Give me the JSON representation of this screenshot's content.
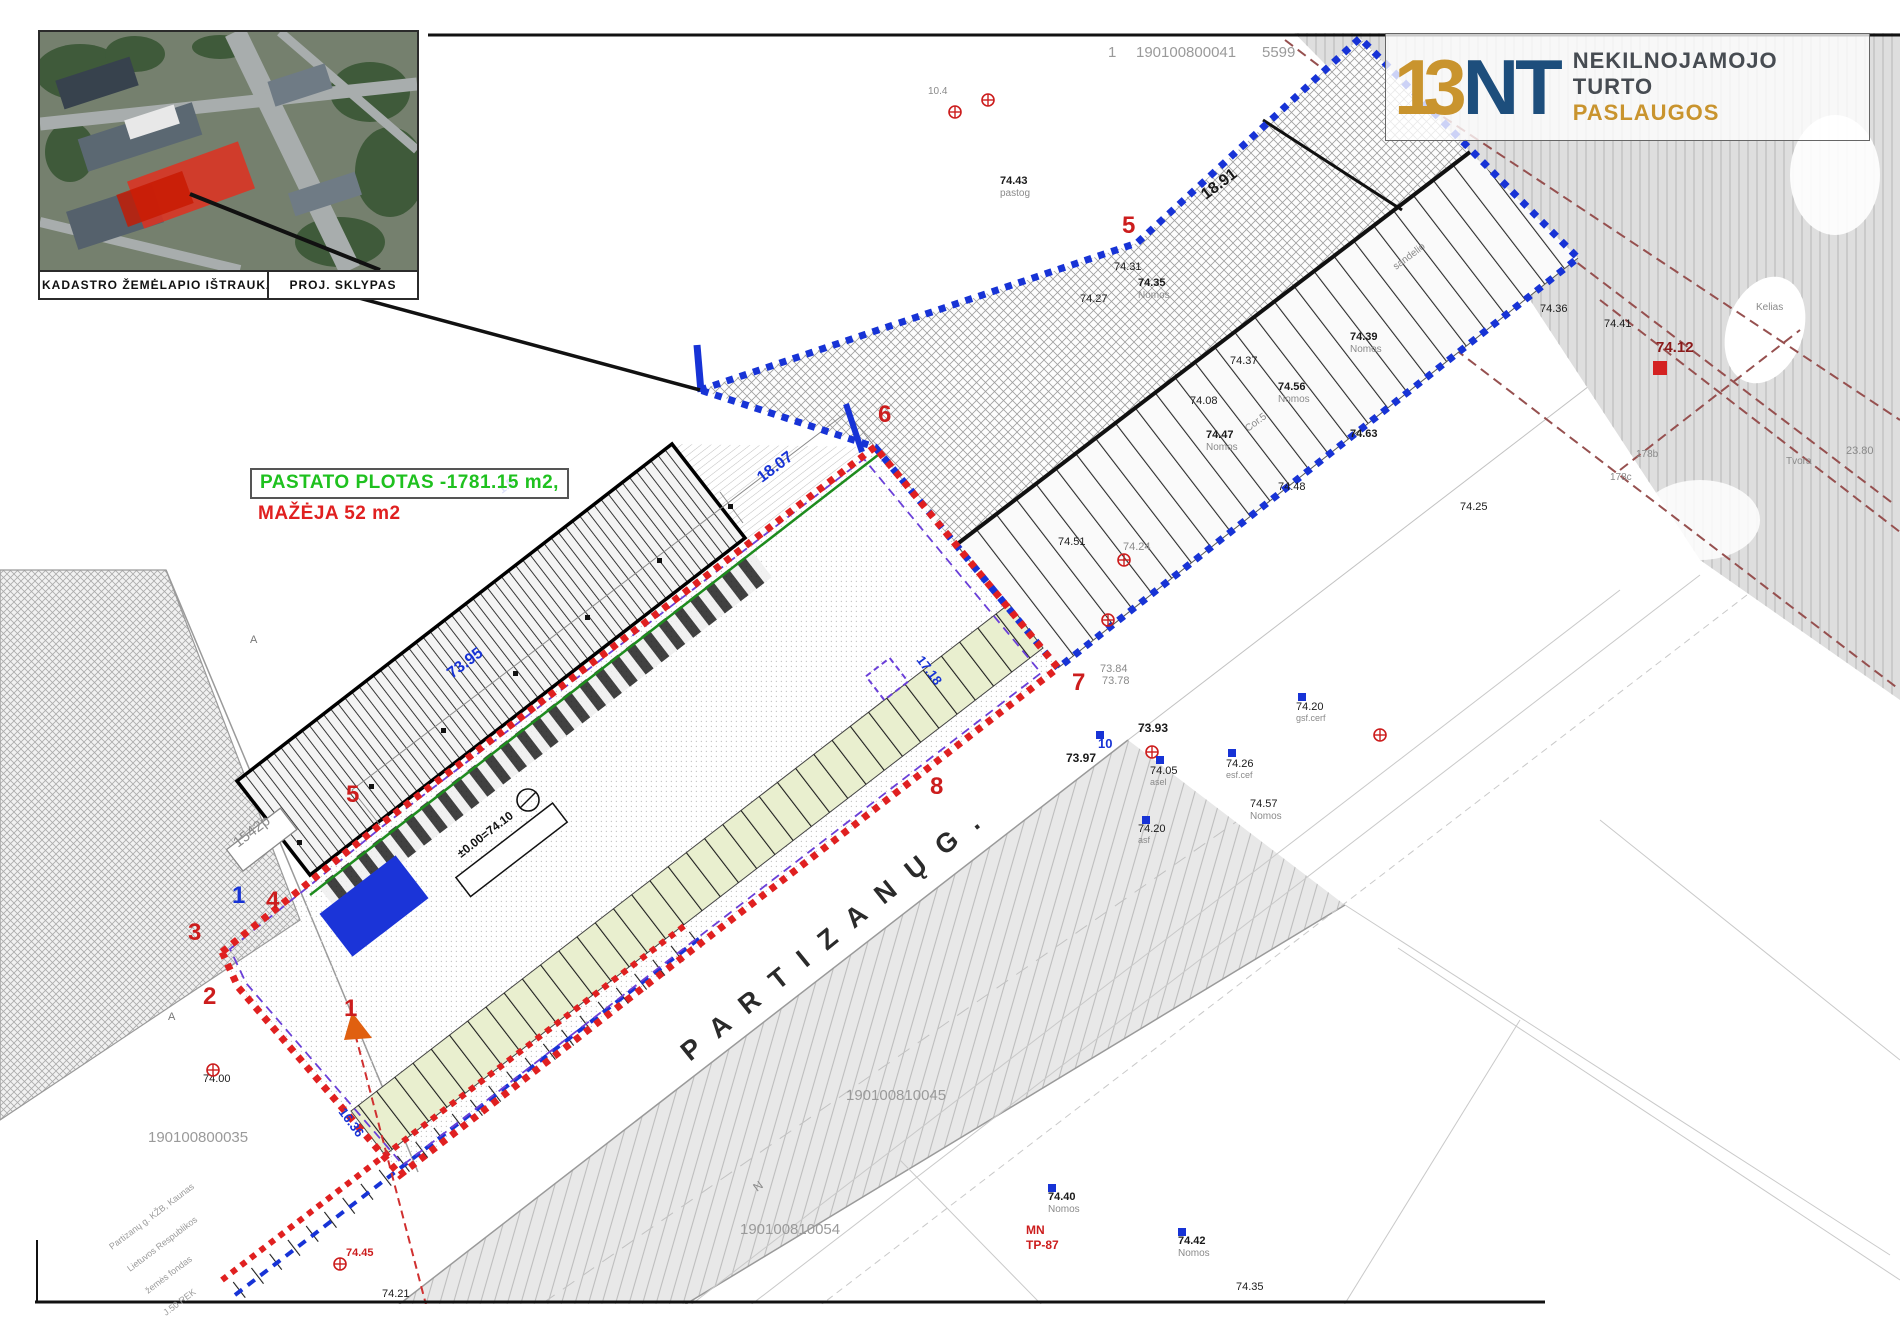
{
  "colors": {
    "red_boundary": "#e02020",
    "blue_boundary": "#1733d6",
    "violet_dash": "#6a3fd8",
    "green_line": "#1e8c1e",
    "logo_navy": "#1d4e7c",
    "logo_gold": "#c9942e",
    "note_green": "#1fc11f",
    "note_red": "#e02020",
    "gray_text": "#9a9a9a"
  },
  "inset": {
    "caption_left": "KADASTRO ŽEMĖLAPIO IŠTRAUKA",
    "caption_right": "PROJ. SKLYPAS"
  },
  "area_note": {
    "line1": "PASTATO PLOTAS -1781.15 m2,",
    "line2": "MAŽĖJA 52 m2"
  },
  "logo": {
    "mark_13": "13",
    "mark_nt": "NT",
    "word1": "NEKILNOJAMOJO",
    "word2": "TURTO",
    "word3": "PASLAUGOS"
  },
  "street": {
    "name": "P A R T I Z A N Ų   G ."
  },
  "plot_tag": "1542p",
  "level_box": "±0.00=74.10",
  "vertices": [
    {
      "t": "1",
      "x": 232,
      "y": 903,
      "c": "#1733d6"
    },
    {
      "t": "2",
      "x": 203,
      "y": 1004,
      "c": "#cc1d1d"
    },
    {
      "t": "3",
      "x": 188,
      "y": 940,
      "c": "#cc1d1d"
    },
    {
      "t": "4",
      "x": 266,
      "y": 908,
      "c": "#cc1d1d"
    },
    {
      "t": "5",
      "x": 346,
      "y": 802,
      "c": "#cc1d1d"
    },
    {
      "t": "6",
      "x": 878,
      "y": 422,
      "c": "#cc1d1d"
    },
    {
      "t": "7",
      "x": 1072,
      "y": 690,
      "c": "#cc1d1d"
    },
    {
      "t": "8",
      "x": 930,
      "y": 794,
      "c": "#cc1d1d"
    },
    {
      "t": "5",
      "x": 1122,
      "y": 233,
      "c": "#cc1d1d"
    },
    {
      "t": "1",
      "x": 344,
      "y": 1016,
      "c": "#cc1d1d"
    }
  ],
  "dimensions": [
    {
      "t": "18.07",
      "x": 762,
      "y": 483,
      "s": 16,
      "rot": -37
    },
    {
      "t": "73.95",
      "x": 452,
      "y": 679,
      "s": 16,
      "rot": -37
    },
    {
      "t": "1.5",
      "x": 502,
      "y": 494,
      "s": 12,
      "rot": -37
    },
    {
      "t": "17.18",
      "x": 916,
      "y": 660,
      "s": 13,
      "rot": 53
    },
    {
      "t": "16.36",
      "x": 338,
      "y": 1112,
      "s": 13,
      "rot": 53
    }
  ],
  "map_labels": [
    {
      "t": "1",
      "x": 1108,
      "y": 57,
      "s": 15,
      "c": "#9a9a9a"
    },
    {
      "t": "190100800041",
      "x": 1136,
      "y": 57,
      "s": 15,
      "c": "#9a9a9a"
    },
    {
      "t": "5599",
      "x": 1262,
      "y": 57,
      "s": 15,
      "c": "#9a9a9a"
    },
    {
      "t": "10.4",
      "x": 928,
      "y": 94,
      "s": 10,
      "c": "#8a8a8a"
    },
    {
      "t": "74.43",
      "x": 1000,
      "y": 184,
      "s": 11,
      "w": "bold"
    },
    {
      "t": "pastog",
      "x": 1000,
      "y": 196,
      "s": 10,
      "c": "#8a8a8a"
    },
    {
      "t": "74.31",
      "x": 1114,
      "y": 270,
      "s": 11
    },
    {
      "t": "74.27",
      "x": 1080,
      "y": 302,
      "s": 11
    },
    {
      "t": "74.35",
      "x": 1138,
      "y": 286,
      "s": 11,
      "w": "bold"
    },
    {
      "t": "Nomos",
      "x": 1138,
      "y": 298,
      "s": 10,
      "c": "#8a8a8a"
    },
    {
      "t": "18.91",
      "x": 1206,
      "y": 200,
      "s": 16,
      "w": "bold",
      "rot": -37
    },
    {
      "t": "sandelio",
      "x": 1396,
      "y": 270,
      "s": 10,
      "c": "#8a8a8a",
      "rot": -37
    },
    {
      "t": "74.56",
      "x": 1278,
      "y": 390,
      "s": 11,
      "w": "bold"
    },
    {
      "t": "Nomos",
      "x": 1278,
      "y": 402,
      "s": 10,
      "c": "#8a8a8a"
    },
    {
      "t": "74.37",
      "x": 1230,
      "y": 364,
      "s": 11
    },
    {
      "t": "74.39",
      "x": 1350,
      "y": 340,
      "s": 11,
      "w": "bold"
    },
    {
      "t": "Nomos",
      "x": 1350,
      "y": 352,
      "s": 10,
      "c": "#8a8a8a"
    },
    {
      "t": "74.08",
      "x": 1190,
      "y": 404,
      "s": 11
    },
    {
      "t": "74.47",
      "x": 1206,
      "y": 438,
      "s": 11,
      "w": "bold"
    },
    {
      "t": "Nomos",
      "x": 1206,
      "y": 450,
      "s": 10,
      "c": "#8a8a8a"
    },
    {
      "t": "Cor.5",
      "x": 1248,
      "y": 432,
      "s": 10,
      "c": "#8a8a8a",
      "rot": -37
    },
    {
      "t": "74.63",
      "x": 1350,
      "y": 437,
      "s": 11,
      "w": "bold"
    },
    {
      "t": "74.48",
      "x": 1278,
      "y": 490,
      "s": 11
    },
    {
      "t": "74.36",
      "x": 1540,
      "y": 312,
      "s": 11
    },
    {
      "t": "74.25",
      "x": 1460,
      "y": 510,
      "s": 11
    },
    {
      "t": "74.51",
      "x": 1058,
      "y": 545,
      "s": 11
    },
    {
      "t": "74.24",
      "x": 1123,
      "y": 550,
      "s": 11,
      "c": "#8a8a8a"
    },
    {
      "t": "73.84",
      "x": 1100,
      "y": 672,
      "s": 11,
      "c": "#8a8a8a"
    },
    {
      "t": "73.78",
      "x": 1102,
      "y": 684,
      "s": 11,
      "c": "#8a8a8a"
    },
    {
      "t": "73.97",
      "x": 1066,
      "y": 762,
      "s": 12,
      "w": "bold"
    },
    {
      "t": "73.93",
      "x": 1138,
      "y": 732,
      "s": 12,
      "w": "bold"
    },
    {
      "t": "74.05",
      "x": 1150,
      "y": 774,
      "s": 11
    },
    {
      "t": "asel",
      "x": 1150,
      "y": 785,
      "s": 9,
      "c": "#8a8a8a"
    },
    {
      "t": "10",
      "x": 1098,
      "y": 748,
      "s": 13,
      "c": "#1733d6",
      "w": "bold"
    },
    {
      "t": "74.20",
      "x": 1138,
      "y": 832,
      "s": 11
    },
    {
      "t": "asf",
      "x": 1138,
      "y": 843,
      "s": 9,
      "c": "#8a8a8a"
    },
    {
      "t": "74.20",
      "x": 1296,
      "y": 710,
      "s": 11
    },
    {
      "t": "gsf.cerf",
      "x": 1296,
      "y": 721,
      "s": 9,
      "c": "#8a8a8a"
    },
    {
      "t": "74.26",
      "x": 1226,
      "y": 767,
      "s": 11
    },
    {
      "t": "esf.cef",
      "x": 1226,
      "y": 778,
      "s": 9,
      "c": "#8a8a8a"
    },
    {
      "t": "74.57",
      "x": 1250,
      "y": 807,
      "s": 11
    },
    {
      "t": "Nomos",
      "x": 1250,
      "y": 819,
      "s": 10,
      "c": "#8a8a8a"
    },
    {
      "t": "74.12",
      "x": 1656,
      "y": 352,
      "s": 15,
      "c": "#8b1a1a",
      "w": "bold"
    },
    {
      "t": "74.41",
      "x": 1604,
      "y": 327,
      "s": 11
    },
    {
      "t": "23.80",
      "x": 1846,
      "y": 454,
      "s": 11,
      "c": "#8a8a8a"
    },
    {
      "t": "178b",
      "x": 1636,
      "y": 457,
      "s": 10,
      "c": "#8a8a8a"
    },
    {
      "t": "178c",
      "x": 1610,
      "y": 480,
      "s": 10,
      "c": "#8a8a8a"
    },
    {
      "t": "Tvora",
      "x": 1786,
      "y": 464,
      "s": 10,
      "c": "#8a8a8a"
    },
    {
      "t": "Kelias",
      "x": 1756,
      "y": 310,
      "s": 10,
      "c": "#8a8a8a"
    },
    {
      "t": "190100800035",
      "x": 148,
      "y": 1142,
      "s": 15,
      "c": "#9a9a9a"
    },
    {
      "t": "74.00",
      "x": 203,
      "y": 1082,
      "s": 11
    },
    {
      "t": "190100810045",
      "x": 846,
      "y": 1100,
      "s": 15,
      "c": "#9a9a9a"
    },
    {
      "t": "190100810054",
      "x": 740,
      "y": 1234,
      "s": 15,
      "c": "#9a9a9a"
    },
    {
      "t": "MN",
      "x": 1026,
      "y": 1234,
      "s": 12,
      "c": "#cc1d1d",
      "w": "bold"
    },
    {
      "t": "TP-87",
      "x": 1026,
      "y": 1249,
      "s": 12,
      "c": "#cc1d1d",
      "w": "bold"
    },
    {
      "t": "74.40",
      "x": 1048,
      "y": 1200,
      "s": 11,
      "w": "bold"
    },
    {
      "t": "Nomos",
      "x": 1048,
      "y": 1212,
      "s": 10,
      "c": "#8a8a8a"
    },
    {
      "t": "74.42",
      "x": 1178,
      "y": 1244,
      "s": 11,
      "w": "bold"
    },
    {
      "t": "Nomos",
      "x": 1178,
      "y": 1256,
      "s": 10,
      "c": "#8a8a8a"
    },
    {
      "t": "74.35",
      "x": 1236,
      "y": 1290,
      "s": 11
    },
    {
      "t": "74.45",
      "x": 346,
      "y": 1256,
      "s": 11,
      "c": "#cc1d1d",
      "w": "bold"
    },
    {
      "t": "74.21",
      "x": 382,
      "y": 1297,
      "s": 11
    },
    {
      "t": "N",
      "x": 757,
      "y": 1192,
      "s": 12,
      "c": "#8a8a8a",
      "rot": -37
    },
    {
      "t": "A",
      "x": 250,
      "y": 643,
      "s": 11,
      "c": "#777777"
    },
    {
      "t": "A",
      "x": 168,
      "y": 1020,
      "s": 11,
      "c": "#777777"
    }
  ],
  "address_lines": [
    {
      "t": "Partizanų g. KŽB, Kaunas",
      "x": 112,
      "y": 1250
    },
    {
      "t": "Lietuvos Respublikos",
      "x": 130,
      "y": 1272
    },
    {
      "t": "žemės fondas",
      "x": 148,
      "y": 1294
    },
    {
      "t": "J.50 REK",
      "x": 166,
      "y": 1316
    }
  ],
  "markers": {
    "red_plus": [
      [
        955,
        112
      ],
      [
        988,
        100
      ],
      [
        213,
        1070
      ],
      [
        340,
        1264
      ],
      [
        1152,
        752
      ],
      [
        1108,
        620
      ],
      [
        1124,
        560
      ],
      [
        1380,
        735
      ]
    ],
    "red_square": [
      [
        1660,
        368
      ]
    ],
    "blue_square": [
      [
        1100,
        735
      ],
      [
        1160,
        760
      ],
      [
        1232,
        753
      ],
      [
        1302,
        697
      ],
      [
        1052,
        1188
      ],
      [
        1182,
        1232
      ],
      [
        1146,
        820
      ]
    ]
  }
}
